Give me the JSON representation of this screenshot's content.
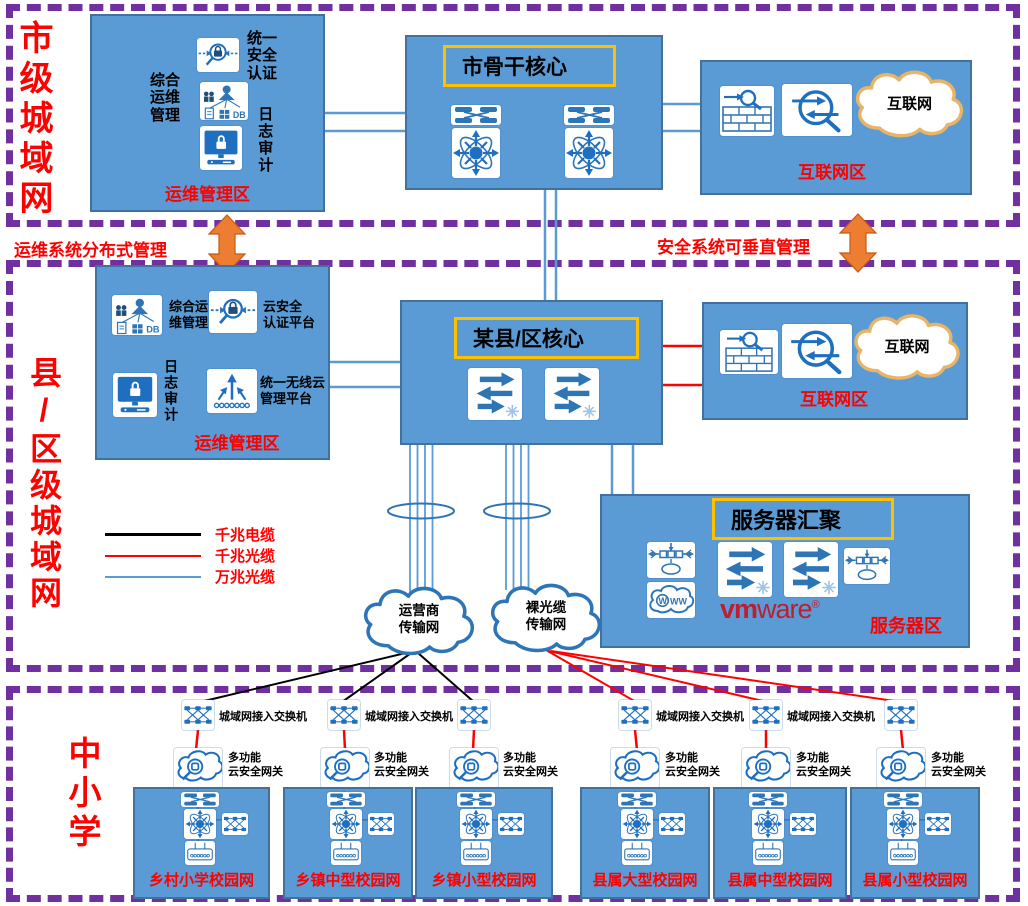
{
  "sections": {
    "city": "市级城域网",
    "county": "县/区级城域网",
    "school": "中小学"
  },
  "banner": {
    "left": "运维系统分布式管理",
    "right": "安全系统可垂直管理"
  },
  "city": {
    "ops": {
      "zone": "运维管理区",
      "auth_label_lines": [
        "统一",
        "安全",
        "认证"
      ],
      "mgmt_label_lines": [
        "综合",
        "运维",
        "管理"
      ],
      "log_label": "日志审计",
      "db_text": "DB",
      "icons": [
        "security-auth-icon",
        "ops-management-icon",
        "log-audit-monitor-icon"
      ]
    },
    "core": {
      "title": "市骨干核心",
      "icons": [
        "switch-icon",
        "switch-icon",
        "router-icon",
        "router-icon"
      ]
    },
    "internet": {
      "zone": "互联网区",
      "cloud": "互联网",
      "icons": [
        "firewall-icon",
        "gateway-icon",
        "internet-cloud-icon"
      ]
    }
  },
  "county": {
    "ops": {
      "zone": "运维管理区",
      "mgmt_label_lines": [
        "综合运",
        "维管理"
      ],
      "cloud_auth_label_lines": [
        "云安全",
        "认证平台"
      ],
      "log_label": "日志审计",
      "wireless_label_lines": [
        "统一无线云",
        "管理平台"
      ],
      "db_text": "DB",
      "icons": [
        "ops-management-icon",
        "security-auth-icon",
        "log-audit-monitor-icon",
        "wireless-controller-icon"
      ]
    },
    "core": {
      "title": "某县/区核心",
      "icons": [
        "l3-switch-icon",
        "l3-switch-icon"
      ]
    },
    "internet": {
      "zone": "互联网区",
      "cloud": "互联网",
      "icons": [
        "firewall-icon",
        "gateway-icon",
        "internet-cloud-icon"
      ]
    },
    "servers": {
      "title": "服务器汇聚",
      "zone": "服务器区",
      "vmware_vm": "vm",
      "vmware_ware": "ware",
      "vmware_reg": "®",
      "icons": [
        "load-balancer-icon",
        "www-cloud-icon",
        "l3-switch-icon",
        "l3-switch-icon",
        "load-balancer-icon"
      ]
    },
    "legend": [
      {
        "label": "千兆电缆",
        "color": "#000000"
      },
      {
        "label": "千兆光缆",
        "color": "#FF0000"
      },
      {
        "label": "万兆光缆",
        "color": "#5B9BD5"
      }
    ],
    "clouds": {
      "carrier_lines": [
        "运营商",
        "传输网"
      ],
      "fiber_lines": [
        "裸光缆",
        "传输网"
      ]
    }
  },
  "schools": {
    "access_switch_label": "城域网接入交换机",
    "gateway_label_lines": [
      "多功能",
      "云安全网关"
    ],
    "campuses": [
      {
        "name": "乡村小学校园网"
      },
      {
        "name": "乡镇中型校园网"
      },
      {
        "name": "乡镇小型校园网"
      },
      {
        "name": "县属大型校园网"
      },
      {
        "name": "县属中型校园网"
      },
      {
        "name": "县属小型校园网"
      }
    ],
    "campus_icons": [
      "crossbar-switch-icon",
      "router-icon",
      "access-switch-icon",
      "wireless-ap-icon"
    ]
  },
  "colors": {
    "box_fill": "#5B9BD5",
    "box_border": "#41719C",
    "section_border": "#7030A0",
    "zone_label": "#FF0000",
    "title_border": "#FFC000",
    "arrow": "#ED7D31",
    "wire_blue": "#5B9BD5",
    "wire_red": "#FF0000",
    "wire_black": "#000000",
    "vmware": "#BE1E2D",
    "internet_cloud_border": "#E8B465",
    "icon_blue": "#2E75B6"
  }
}
